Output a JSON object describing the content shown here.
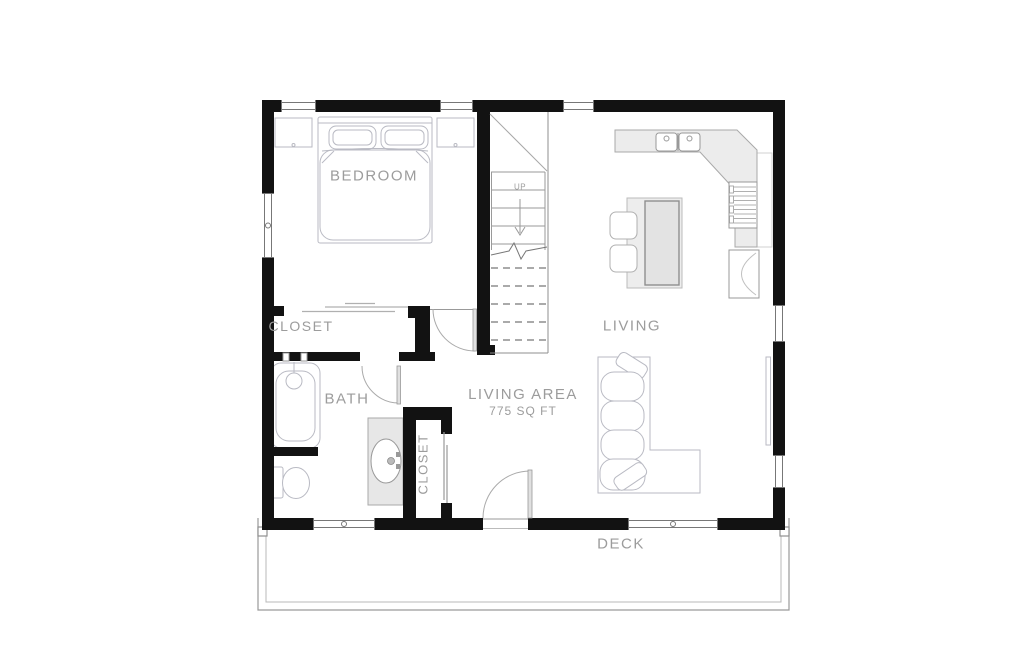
{
  "plan": {
    "rooms": {
      "bedroom": "BEDROOM",
      "closet_upper": "CLOSET",
      "bath": "BATH",
      "closet_lower": "CLOSET",
      "living_area_label": "LIVING AREA",
      "living_area_sqft": "775 SQ FT",
      "living": "LIVING",
      "deck": "DECK"
    },
    "stairs": {
      "up_label": "UP"
    },
    "colors": {
      "wall": "#121212",
      "label_text": "#9c9c9c",
      "furniture_line": "#b9bac3",
      "counter_fill": "#ececec",
      "thin_line": "#8f8f8f"
    }
  }
}
